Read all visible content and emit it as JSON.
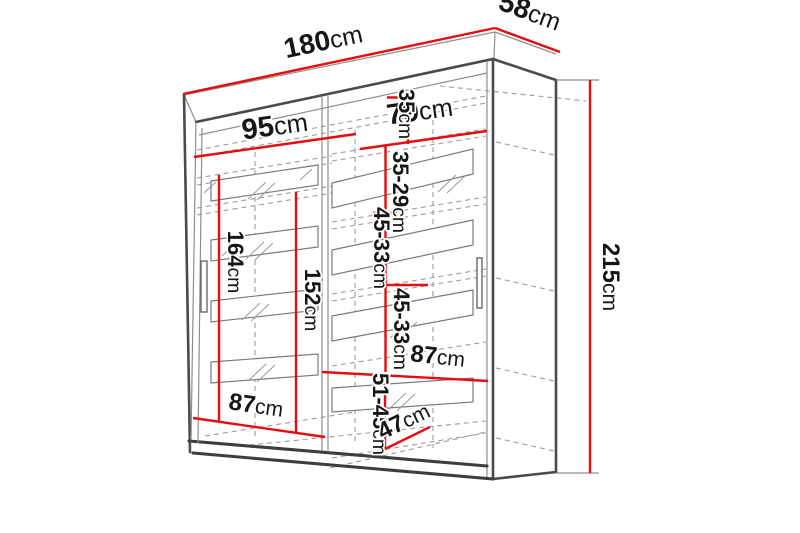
{
  "diagram": {
    "kind": "wardrobe-dimension-drawing",
    "colors": {
      "dimension_red": "#e60d11",
      "outline_gray": "#4a4a4a",
      "hidden_line_gray": "#9c9c9c",
      "background": "#ffffff"
    },
    "dimensions": {
      "width_total": {
        "value": "180",
        "unit": "cm"
      },
      "depth": {
        "value": "58",
        "unit": "cm"
      },
      "height": {
        "value": "215",
        "unit": "cm"
      },
      "door_left_width": {
        "value": "95",
        "unit": "cm"
      },
      "door_right_width": {
        "value": "79",
        "unit": "cm"
      },
      "gap_top": {
        "value": "35",
        "unit": "cm"
      },
      "gap_second": {
        "value": "35-29",
        "unit": "cm"
      },
      "gap_third": {
        "value": "45-33",
        "unit": "cm"
      },
      "gap_fourth": {
        "value": "45-33",
        "unit": "cm"
      },
      "interior_height_left": {
        "value": "164",
        "unit": "cm"
      },
      "hanging_height": {
        "value": "152",
        "unit": "cm"
      },
      "interior_width_right": {
        "value": "87",
        "unit": "cm"
      },
      "interior_width_left": {
        "value": "87",
        "unit": "cm"
      },
      "gap_bottom": {
        "value": "51-45",
        "unit": "cm"
      },
      "interior_depth_bottom": {
        "value": "47",
        "unit": "cm"
      }
    }
  }
}
